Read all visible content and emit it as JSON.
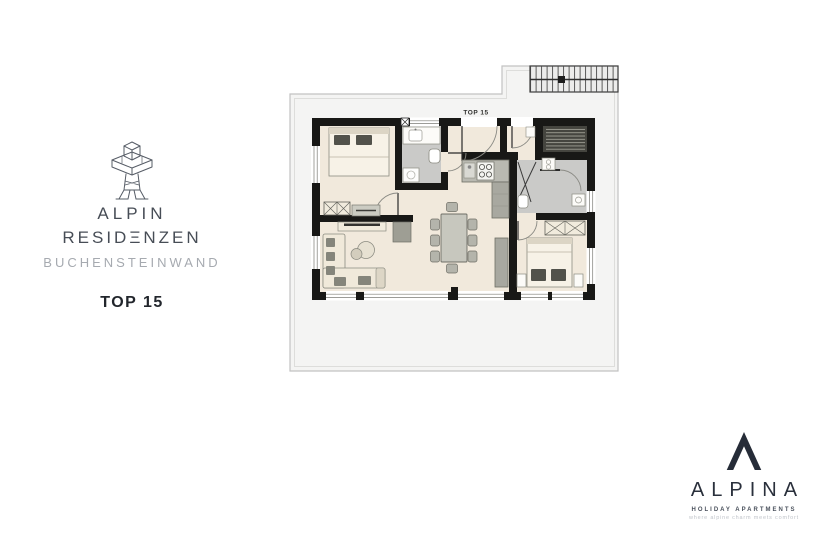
{
  "branding": {
    "logo": "jakobskreuz-wireframe",
    "line1": "ALPIN",
    "line2": "RESIDΞNZEN",
    "line3": "BUCHENSTEINWAND",
    "unit": "TOP 15",
    "text_color": "#474d56",
    "muted_color": "#a6aab0"
  },
  "plan": {
    "label": "TOP 15",
    "colors": {
      "wall": "#181816",
      "floor": "#f1e9dc",
      "wet_floor": "#cacac8",
      "terrace": "#f4f4f3",
      "sauna": "#45453f",
      "furniture": "#b9b9b1"
    }
  },
  "footer": {
    "symbol": "lambda-monogram",
    "brand": "ALPINA",
    "subtitle": "HOLIDAY APARTMENTS",
    "tagline": "where alpine charm meets comfort",
    "color": "#2a303c"
  }
}
